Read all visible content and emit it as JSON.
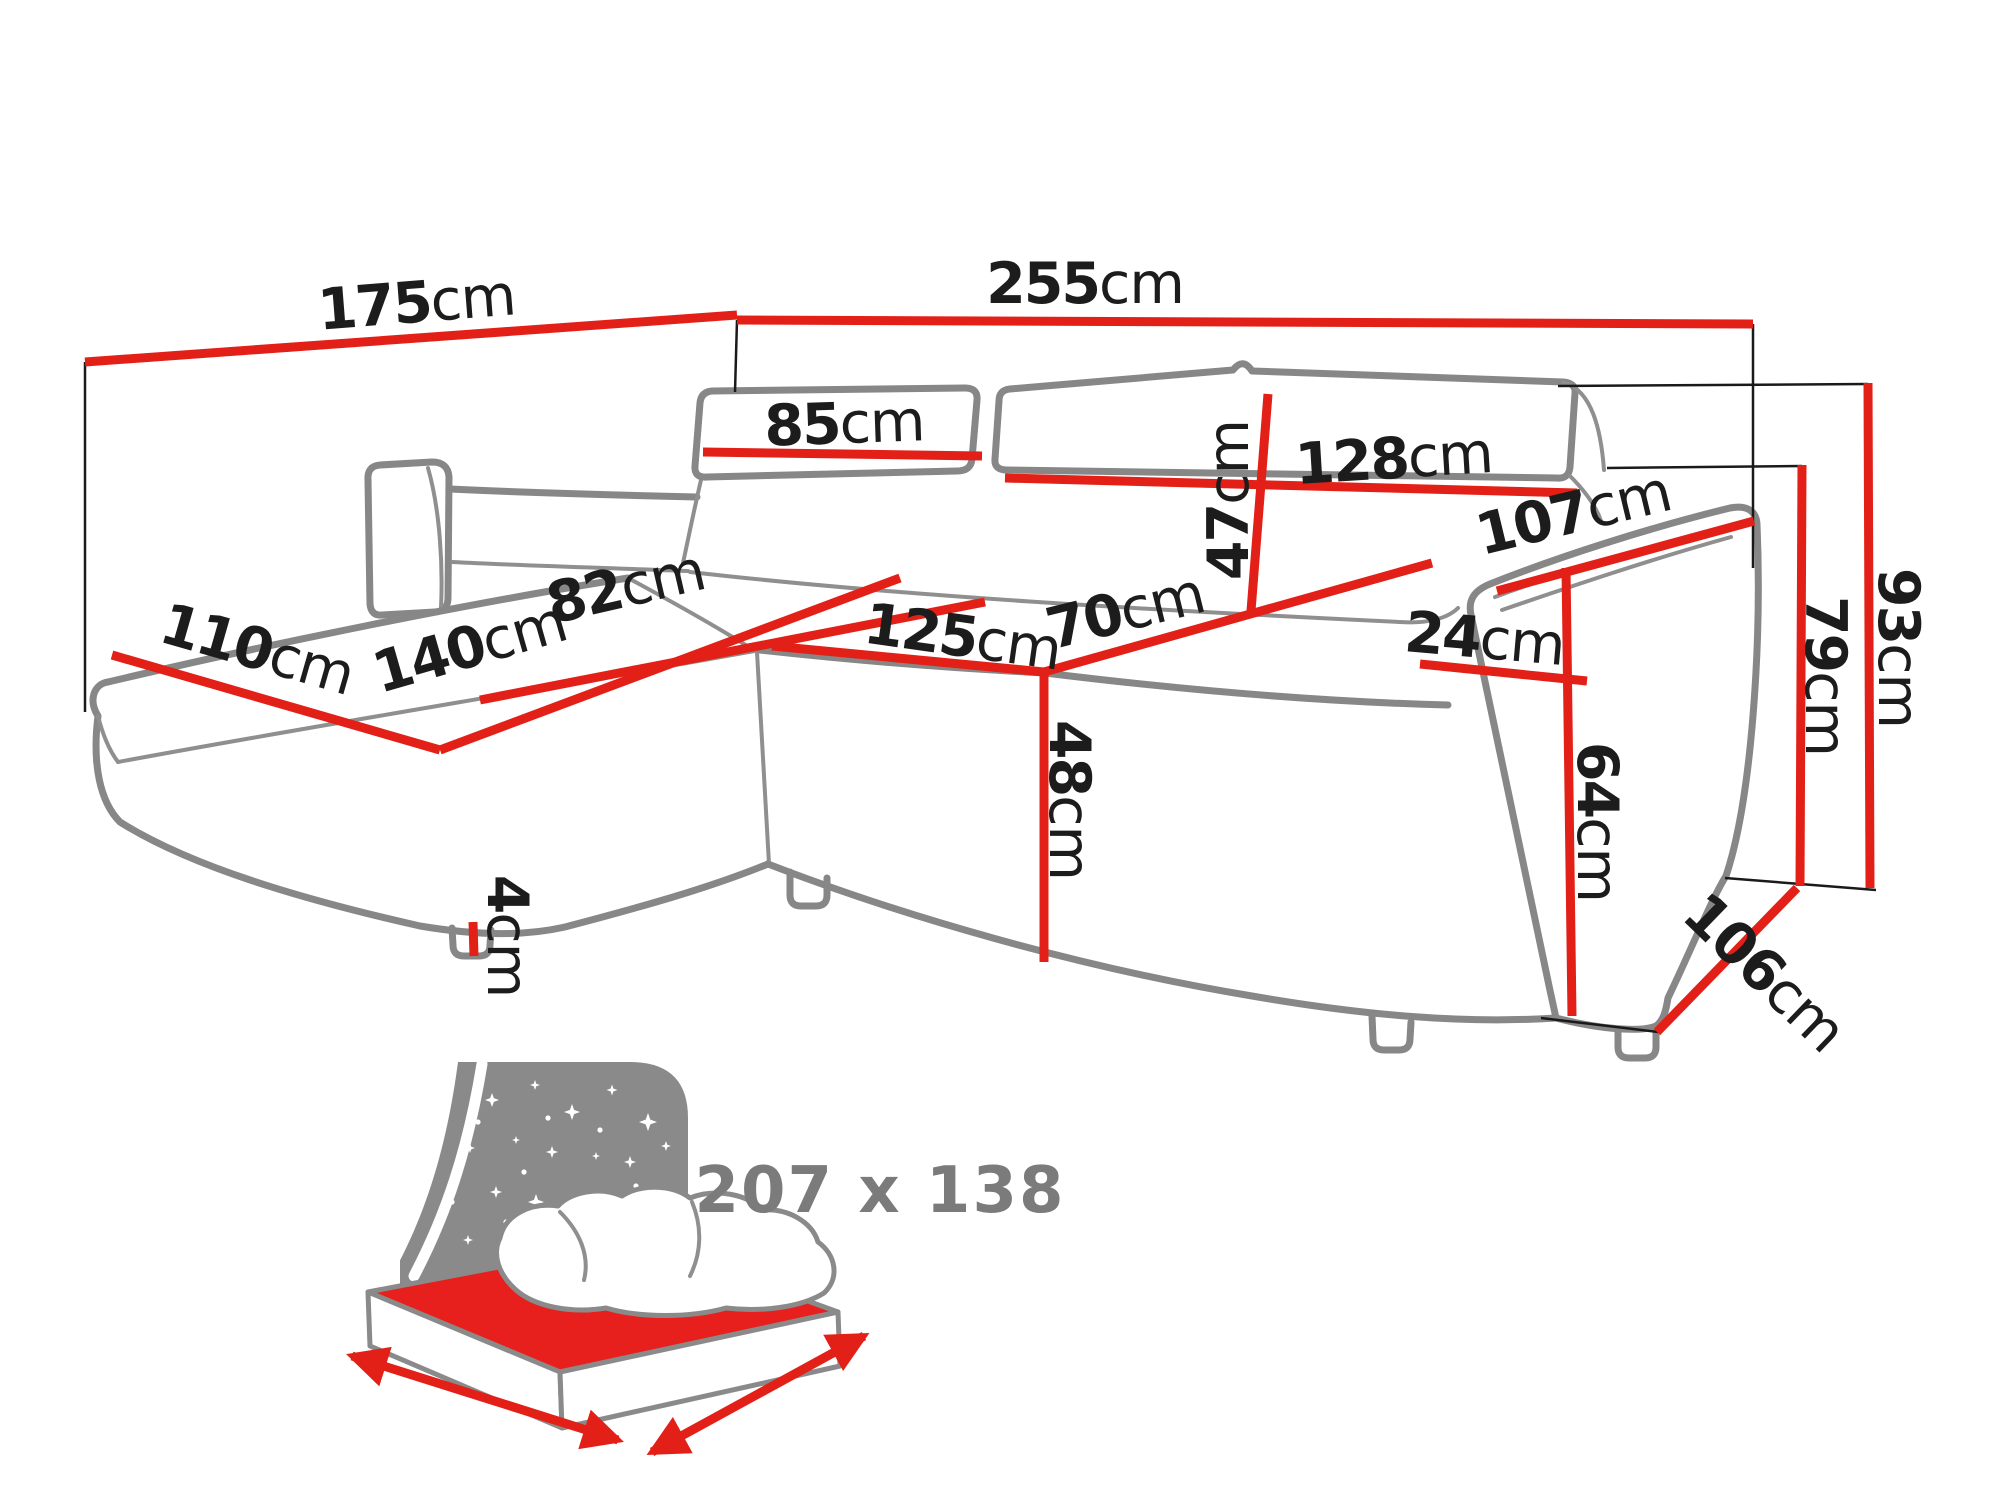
{
  "diagram": {
    "type": "corner-sofa dimension drawing",
    "unit": "cm"
  },
  "dims": {
    "d175": {
      "v": "175",
      "u": "cm"
    },
    "d255": {
      "v": "255",
      "u": "cm"
    },
    "d85": {
      "v": "85",
      "u": "cm"
    },
    "d128": {
      "v": "128",
      "u": "cm"
    },
    "d47": {
      "v": "47",
      "u": "cm"
    },
    "d107": {
      "v": "107",
      "u": "cm"
    },
    "d82": {
      "v": "82",
      "u": "cm"
    },
    "d140": {
      "v": "140",
      "u": "cm"
    },
    "d110": {
      "v": "110",
      "u": "cm"
    },
    "d125": {
      "v": "125",
      "u": "cm"
    },
    "d70": {
      "v": "70",
      "u": "cm"
    },
    "d24": {
      "v": "24",
      "u": "cm"
    },
    "d48": {
      "v": "48",
      "u": "cm"
    },
    "d64": {
      "v": "64",
      "u": "cm"
    },
    "d79": {
      "v": "79",
      "u": "cm"
    },
    "d93": {
      "v": "93",
      "u": "cm"
    },
    "d106": {
      "v": "106",
      "u": "cm"
    },
    "d4": {
      "v": "4",
      "u": "cm"
    }
  },
  "sleep_icon": {
    "size_label": "207 x 138"
  },
  "colors": {
    "dimension_red": "#e32017",
    "sofa_outline_gray": "#878787",
    "icon_gray": "#8a8a8a",
    "label_black": "#1c1c1c",
    "icon_text_gray": "#7b7b7b"
  }
}
